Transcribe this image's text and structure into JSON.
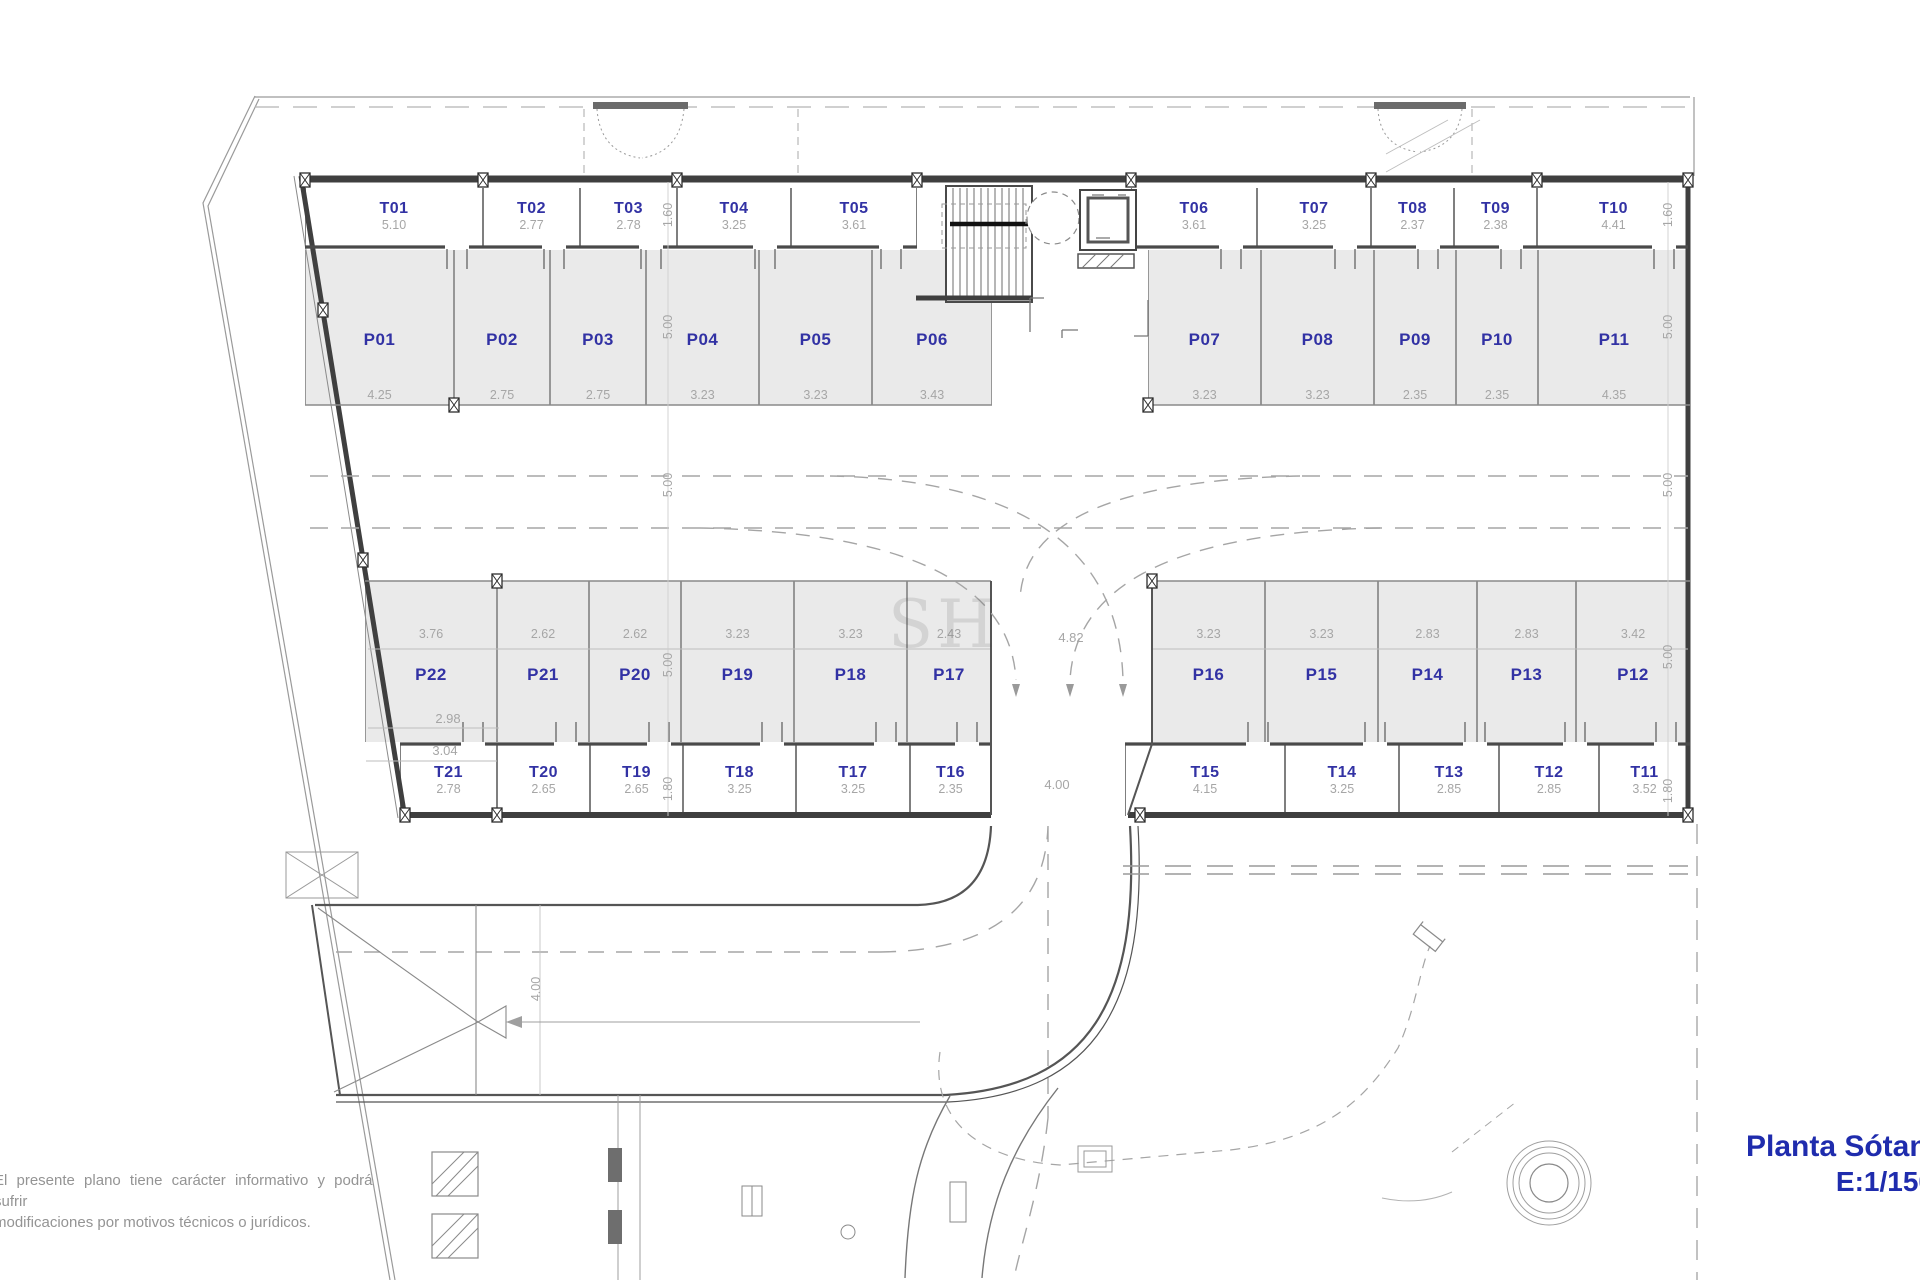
{
  "title_block": {
    "title": "Planta Sótano",
    "scale_label": "E:1/150"
  },
  "disclaimer": {
    "line1": "El presente plano tiene carácter informativo y podrá sufrir",
    "line2": "modificaciones por motivos técnicos o jurídicos."
  },
  "watermark": {
    "text": "SH"
  },
  "parking": [
    {
      "id": "P01",
      "size": "4.25"
    },
    {
      "id": "P02",
      "size": "2.75"
    },
    {
      "id": "P03",
      "size": "2.75"
    },
    {
      "id": "P04",
      "size": "3.23"
    },
    {
      "id": "P05",
      "size": "3.23"
    },
    {
      "id": "P06",
      "size": "3.43"
    },
    {
      "id": "P07",
      "size": "3.23"
    },
    {
      "id": "P08",
      "size": "3.23"
    },
    {
      "id": "P09",
      "size": "2.35"
    },
    {
      "id": "P10",
      "size": "2.35"
    },
    {
      "id": "P11",
      "size": "4.35"
    },
    {
      "id": "P12",
      "size": "3.42"
    },
    {
      "id": "P13",
      "size": "2.83"
    },
    {
      "id": "P14",
      "size": "2.83"
    },
    {
      "id": "P15",
      "size": "3.23"
    },
    {
      "id": "P16",
      "size": "3.23"
    },
    {
      "id": "P17",
      "size": "2.43"
    },
    {
      "id": "P18",
      "size": "3.23"
    },
    {
      "id": "P19",
      "size": "3.23"
    },
    {
      "id": "P20",
      "size": "2.62"
    },
    {
      "id": "P21",
      "size": "2.62"
    },
    {
      "id": "P22",
      "size": "3.76"
    }
  ],
  "storage": [
    {
      "id": "T01",
      "size": "5.10"
    },
    {
      "id": "T02",
      "size": "2.77"
    },
    {
      "id": "T03",
      "size": "2.78"
    },
    {
      "id": "T04",
      "size": "3.25"
    },
    {
      "id": "T05",
      "size": "3.61"
    },
    {
      "id": "T06",
      "size": "3.61"
    },
    {
      "id": "T07",
      "size": "3.25"
    },
    {
      "id": "T08",
      "size": "2.37"
    },
    {
      "id": "T09",
      "size": "2.38"
    },
    {
      "id": "T10",
      "size": "4.41"
    },
    {
      "id": "T11",
      "size": "3.52"
    },
    {
      "id": "T12",
      "size": "2.85"
    },
    {
      "id": "T13",
      "size": "2.85"
    },
    {
      "id": "T14",
      "size": "3.25"
    },
    {
      "id": "T15",
      "size": "4.15"
    },
    {
      "id": "T16",
      "size": "2.35"
    },
    {
      "id": "T17",
      "size": "3.25"
    },
    {
      "id": "T18",
      "size": "3.25"
    },
    {
      "id": "T19",
      "size": "2.65"
    },
    {
      "id": "T20",
      "size": "2.65"
    },
    {
      "id": "T21",
      "size": "2.78"
    }
  ],
  "dims": {
    "left_chain": [
      "1.60",
      "5.00",
      "5.00",
      "5.00",
      "1.80"
    ],
    "right_chain": [
      "1.60",
      "5.00",
      "5.00",
      "5.00",
      "1.80"
    ],
    "junction_width": "4.82",
    "gate_width": "4.00",
    "ramp_width": "4.00",
    "p22_inner_a": "2.98",
    "p22_inner_b": "3.04"
  },
  "colors": {
    "stall_label": "#3232a4",
    "dimension_text": "#a6a6a6",
    "title_blue": "#1f2cad",
    "stall_fill": "#eaeaea",
    "wall": "#3f3f3f"
  }
}
